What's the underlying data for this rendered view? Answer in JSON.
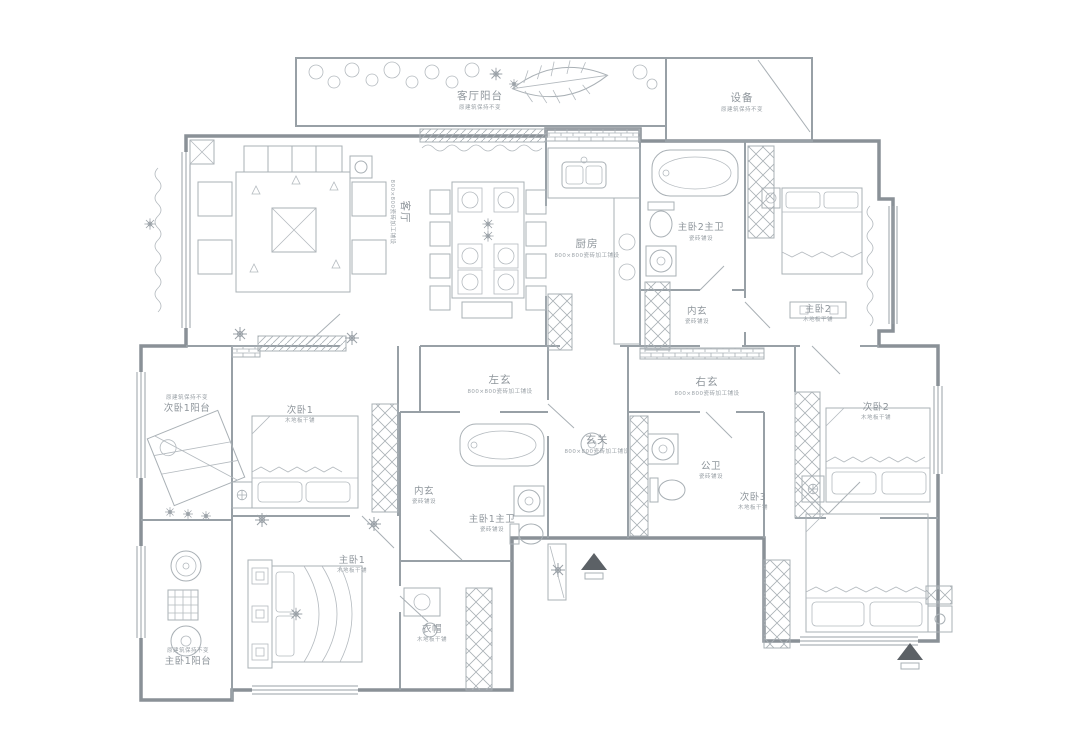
{
  "title": "apartment-floor-plan",
  "palette": {
    "background": "#ffffff",
    "wall_line": "#8a9197",
    "thin_line": "#a9b0b5",
    "text": "#8e959b",
    "dark_accent": "#5c6166"
  },
  "icons": {
    "plant": "plant-icon",
    "entry_arrow": "entry-arrow-icon",
    "lamp": "table-lamp-icon",
    "washer": "round-washer-icon"
  },
  "rooms": [
    {
      "id": "living-balcony",
      "label": "客厅阳台",
      "note": "原建筑保持不变"
    },
    {
      "id": "equipment",
      "label": "设备",
      "note": "原建筑保持不变"
    },
    {
      "id": "living",
      "label": "客厅",
      "note": "800×800瓷砖加工铺设"
    },
    {
      "id": "kitchen",
      "label": "厨房",
      "note": "800×800瓷砖加工铺设"
    },
    {
      "id": "master2-bath",
      "label": "主卧2主卫",
      "note": "瓷砖铺设"
    },
    {
      "id": "inner-hall-right",
      "label": "内玄",
      "note": "瓷砖铺设"
    },
    {
      "id": "master2",
      "label": "主卧2",
      "note": "木地板干铺"
    },
    {
      "id": "left-hall",
      "label": "左玄",
      "note": "800×800瓷砖加工铺设"
    },
    {
      "id": "right-hall",
      "label": "右玄",
      "note": "800×800瓷砖加工铺设"
    },
    {
      "id": "entry-hall",
      "label": "玄关",
      "note": "800×800瓷砖加工铺设"
    },
    {
      "id": "public-bath",
      "label": "公卫",
      "note": "瓷砖铺设"
    },
    {
      "id": "bedroom-1",
      "label": "次卧1",
      "note": "木地板干铺"
    },
    {
      "id": "bedroom1-balcony",
      "label": "次卧1阳台",
      "note": "原建筑保持不变"
    },
    {
      "id": "inner-hall-left",
      "label": "内玄",
      "note": "瓷砖铺设"
    },
    {
      "id": "master1-bath",
      "label": "主卧1主卫",
      "note": "瓷砖铺设"
    },
    {
      "id": "master1",
      "label": "主卧1",
      "note": "木地板干铺"
    },
    {
      "id": "cloakroom",
      "label": "衣帽",
      "note": "木地板干铺"
    },
    {
      "id": "master1-balcony",
      "label": "主卧1阳台",
      "note": "原建筑保持不变"
    },
    {
      "id": "bedroom-2",
      "label": "次卧2",
      "note": "木地板干铺"
    },
    {
      "id": "bedroom-3",
      "label": "次卧3",
      "note": "木地板干铺"
    }
  ]
}
